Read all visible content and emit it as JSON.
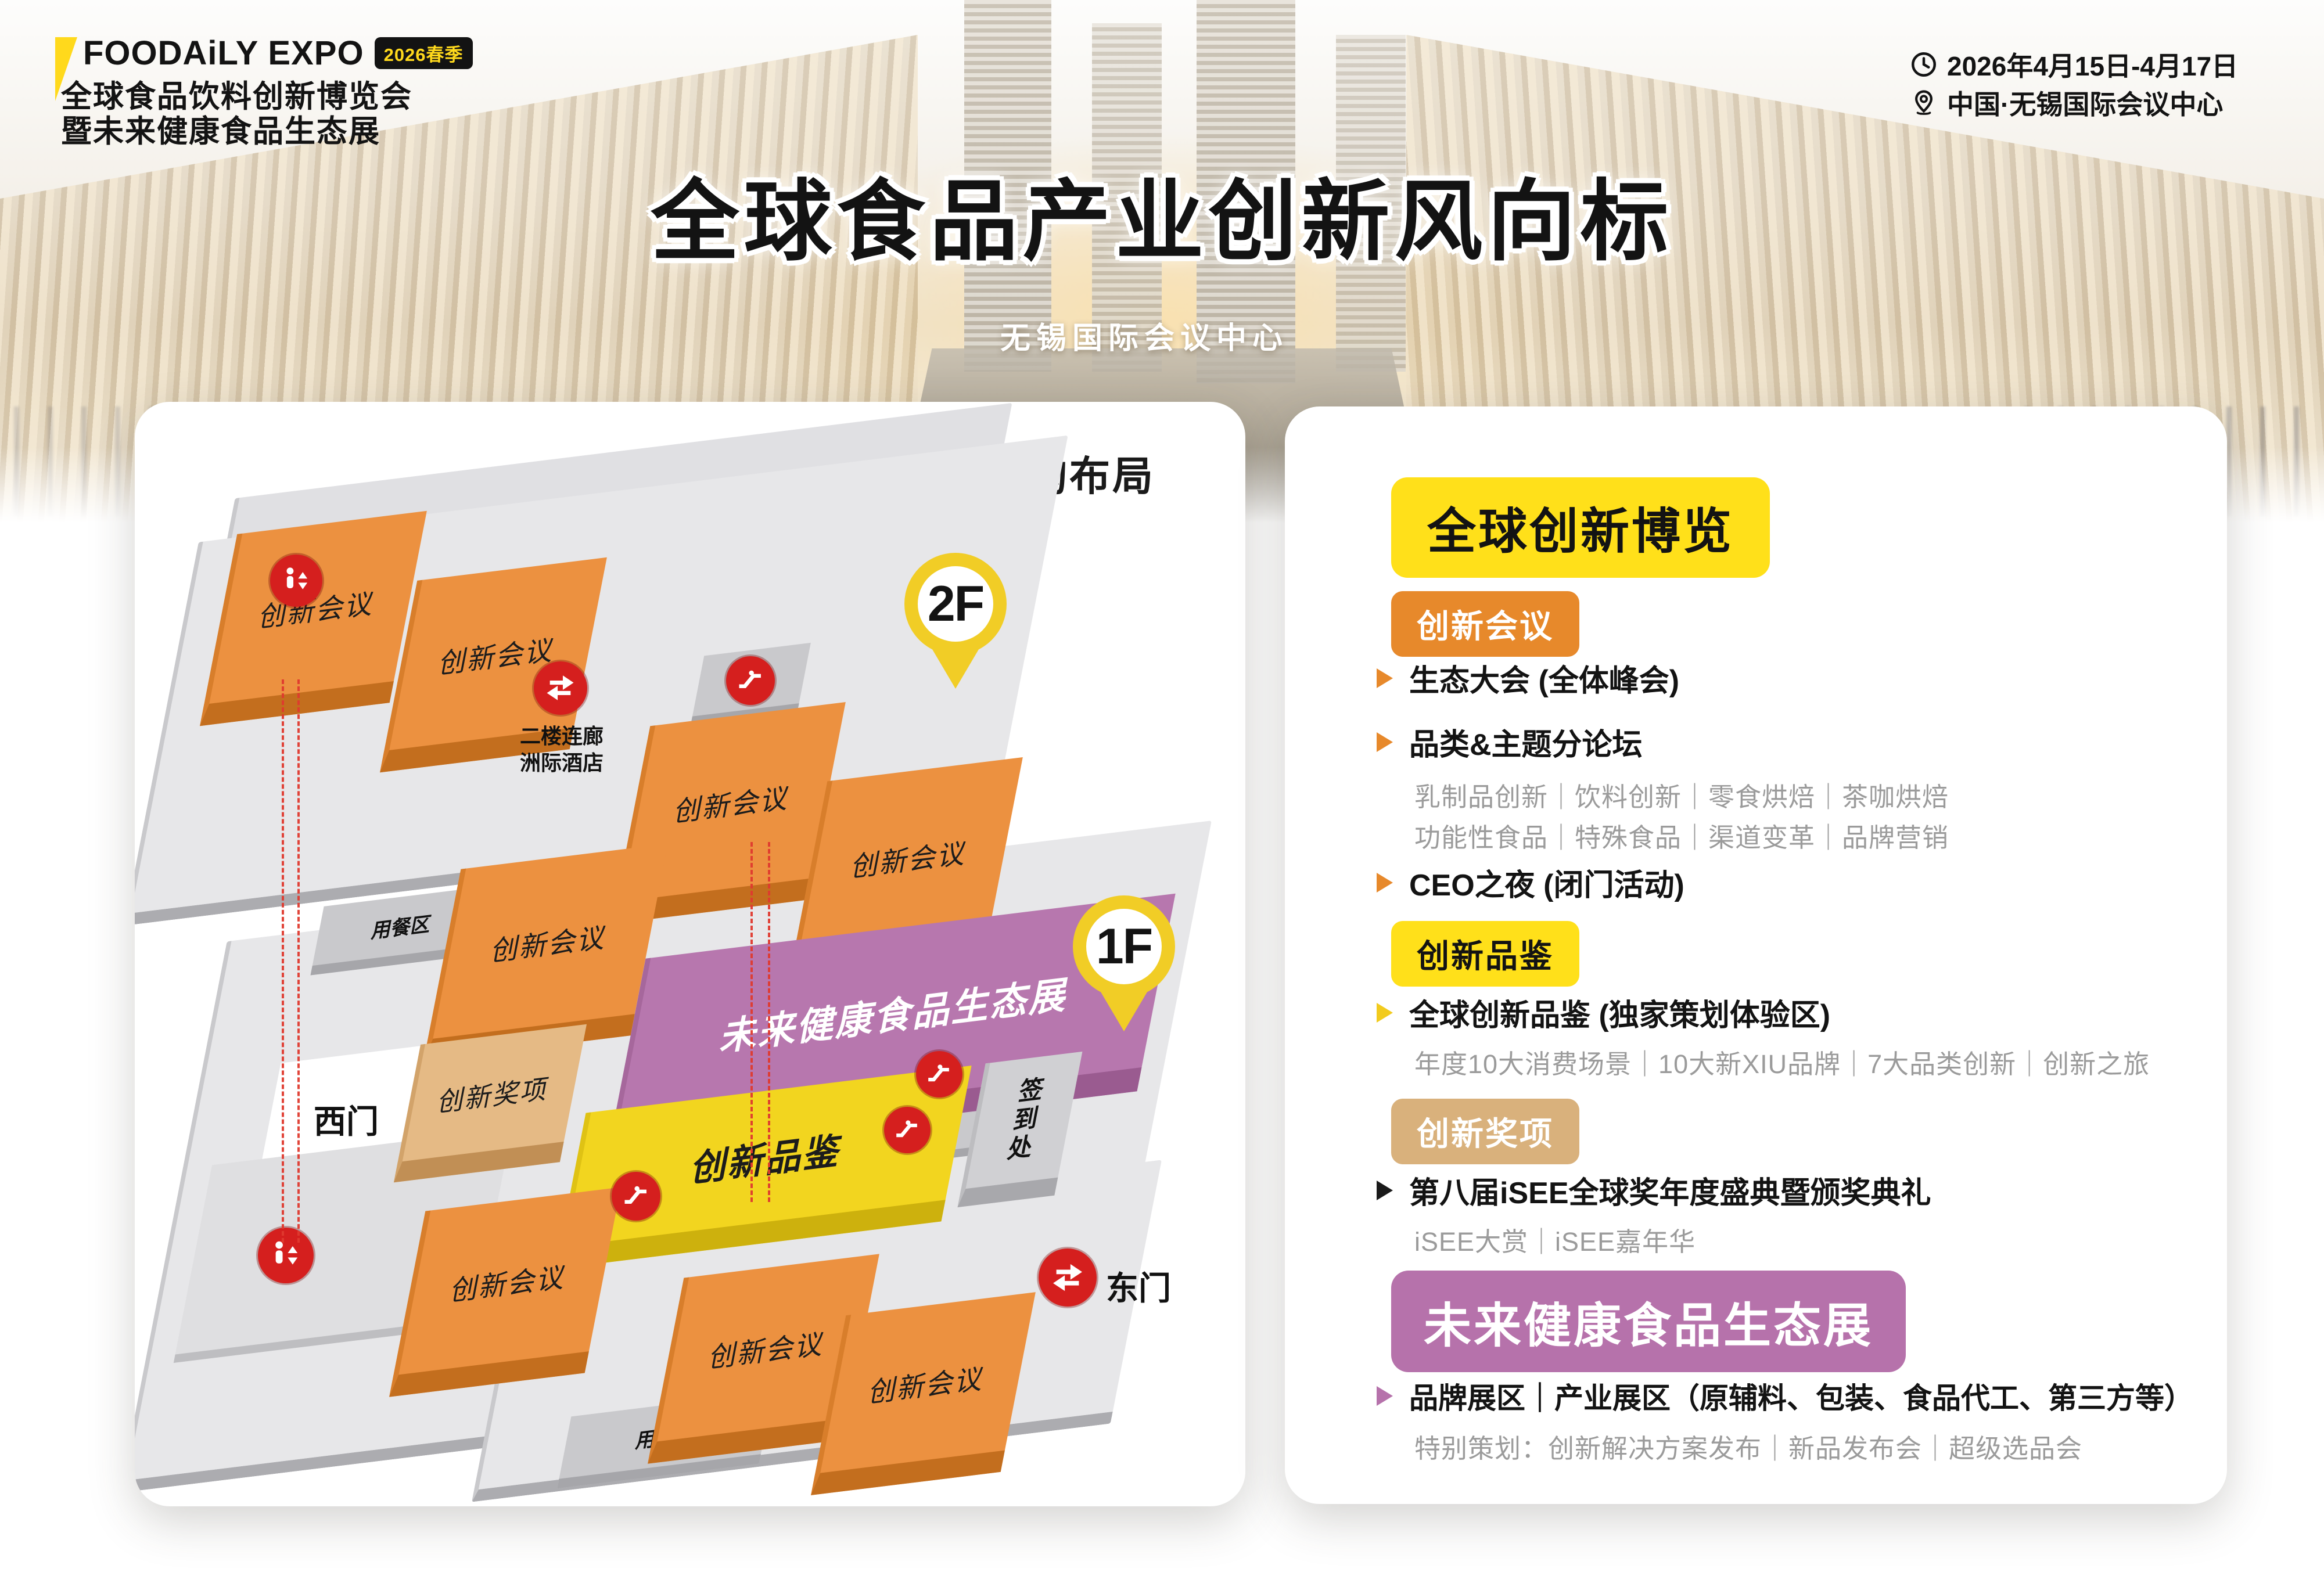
{
  "header": {
    "logo": {
      "brand": "FOODAiLY EXPO",
      "edition_badge": "2026春季",
      "line1": "全球食品饮料创新博览会",
      "line2": "暨未来健康食品生态展"
    },
    "info": {
      "dates": "2026年4月15日-4月17日",
      "venue": "中国·无锡国际会议中心"
    },
    "main_title": "全球食品产业创新风向标",
    "building_sign": "无锡国际会议中心"
  },
  "map": {
    "title": "整体结构布局",
    "pins": {
      "floor2": "2F",
      "floor1": "1F"
    },
    "floor2": {
      "rooms": [
        "创新会议",
        "创新会议",
        "创新会议",
        "创新会议"
      ],
      "bridge_line1": "二楼连廊",
      "bridge_line2": "洲际酒店"
    },
    "floor1": {
      "room_top": "创新会议",
      "rooms_bottom": [
        "创新会议",
        "创新会议",
        "创新会议"
      ],
      "expo_hall": "未来健康食品生态展",
      "tasting": "创新品鉴",
      "awards": "创新奖项",
      "signin": "签到处",
      "dining_top": "用餐区",
      "dining_bottom": "用餐区",
      "west_gate": "西门",
      "east_gate": "东门"
    }
  },
  "panel": {
    "title": "全球创新博览",
    "sections": [
      {
        "badge": "创新会议",
        "items": [
          {
            "label": "生态大会 (全体峰会)"
          },
          {
            "label": "品类&主题分论坛",
            "sub1": "乳制品创新｜饮料创新｜零食烘焙｜茶咖烘焙",
            "sub2": "功能性食品｜特殊食品｜渠道变革｜品牌营销"
          },
          {
            "label": "CEO之夜 (闭门活动)"
          }
        ]
      },
      {
        "badge": "创新品鉴",
        "items": [
          {
            "label": "全球创新品鉴 (独家策划体验区)",
            "sub1": "年度10大消费场景｜10大新XIU品牌｜7大品类创新｜创新之旅"
          }
        ]
      },
      {
        "badge": "创新奖项",
        "items": [
          {
            "label": "第八届iSEE全球奖年度盛典暨颁奖典礼",
            "sub1": "iSEE大赏｜iSEE嘉年华"
          }
        ]
      }
    ],
    "exhibition": {
      "badge": "未来健康食品生态展",
      "item": "品牌展区｜产业展区（原辅料、包装、食品代工、第三方等）",
      "sub": "特别策划：创新解决方案发布｜新品发布会｜超级选品会"
    }
  },
  "colors": {
    "brand_yellow": "#FFE01A",
    "orange": "#E7892B",
    "tan": "#D9B17C",
    "purple": "#B672AB",
    "box_orange": "#EC9140",
    "box_yellow": "#F2D51F",
    "box_purple": "#B777AE",
    "icon_red": "#D51F1E",
    "pin_yellow": "#F1CD26",
    "muted_text": "#9B9B9B"
  }
}
